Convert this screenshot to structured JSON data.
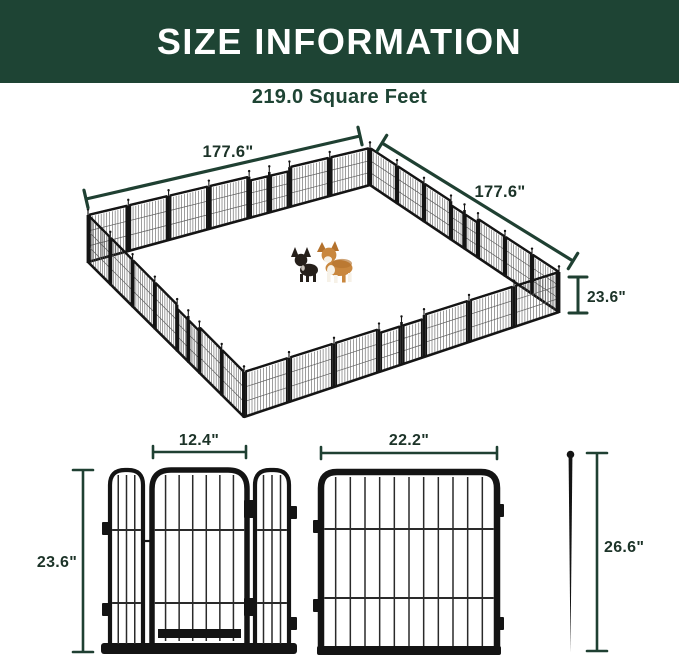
{
  "header": {
    "title": "SIZE INFORMATION"
  },
  "area": {
    "label": "219.0 Square Feet"
  },
  "pen": {
    "side_left_label": "177.6\"",
    "side_right_label": "177.6\"",
    "height_label": "23.6\""
  },
  "door_panel": {
    "width_label": "12.4\"",
    "height_label": "23.6\""
  },
  "large_panel": {
    "width_label": "22.2\""
  },
  "stake": {
    "height_label": "26.6\""
  },
  "colors": {
    "banner_green": "#1e4434",
    "subtitle_green": "#1e4434",
    "dim_green": "#1f4032",
    "dim_text": "#1c3328",
    "fence_black": "#141414",
    "mesh_gray": "#4f4f4f",
    "wire_gray": "#5d5d5d",
    "dog_black": "#26201b",
    "dog_tan": "#c9873e",
    "dog_tan_dark": "#b3712c",
    "dog_white": "#f6f1e7"
  }
}
